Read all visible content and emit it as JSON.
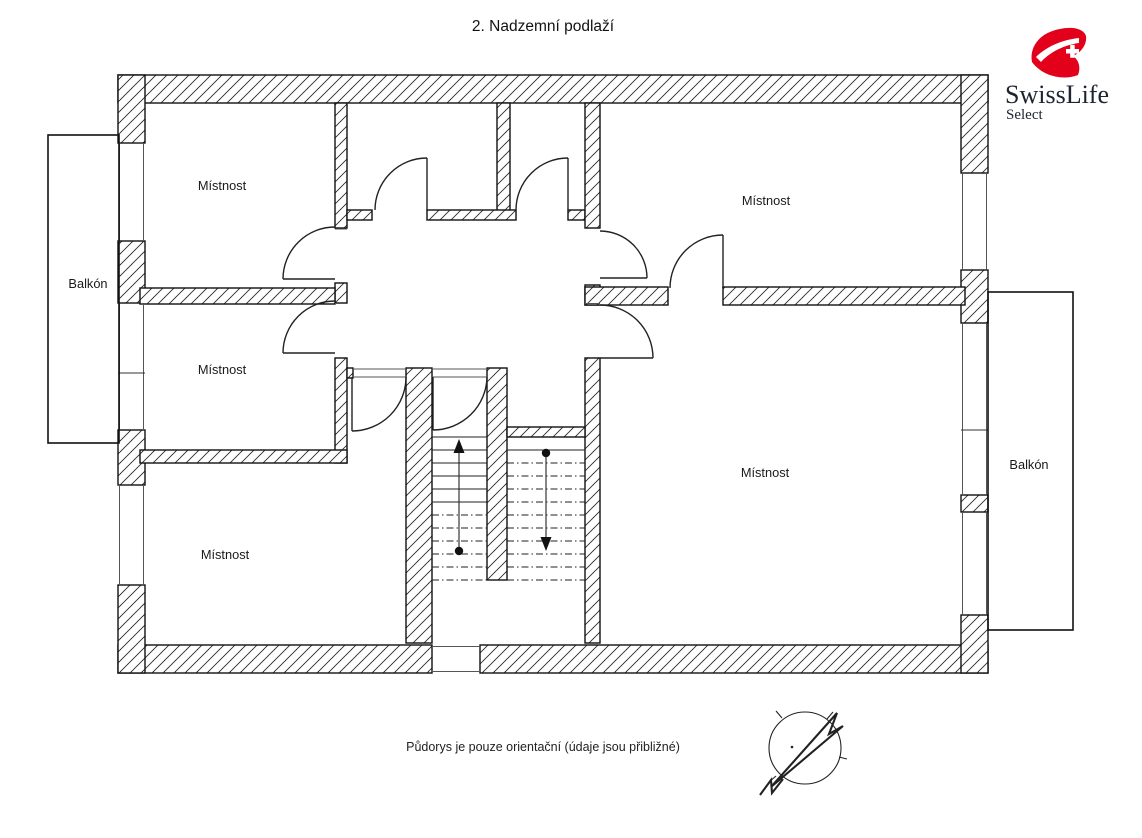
{
  "title": "2. Nadzemní podlaží",
  "floorplan": {
    "rooms": [
      {
        "id": "top-left",
        "label": "Místnost"
      },
      {
        "id": "top-right",
        "label": "Místnost"
      },
      {
        "id": "mid-left",
        "label": "Místnost"
      },
      {
        "id": "right-large",
        "label": "Místnost"
      },
      {
        "id": "bottom-left",
        "label": "Místnost"
      }
    ],
    "balconies": [
      {
        "id": "left",
        "label": "Balkón"
      },
      {
        "id": "right",
        "label": "Balkón"
      }
    ],
    "stairs": {
      "up_marker": "up-arrow-icon",
      "down_marker": "down-arrow-icon"
    },
    "compass": "north-arrow-icon"
  },
  "logo": {
    "brand": "SwissLife",
    "subbrand": "Select",
    "brand_red": "#e2001a",
    "brand_text_color": "#1c2430"
  },
  "disclaimer": "Půdorys je pouze orientační (údaje jsou přibližné)",
  "drawing_colors": {
    "wall_line": "#111111",
    "hatch": "#2a2a2a",
    "window_line": "#555555",
    "background": "#ffffff"
  }
}
